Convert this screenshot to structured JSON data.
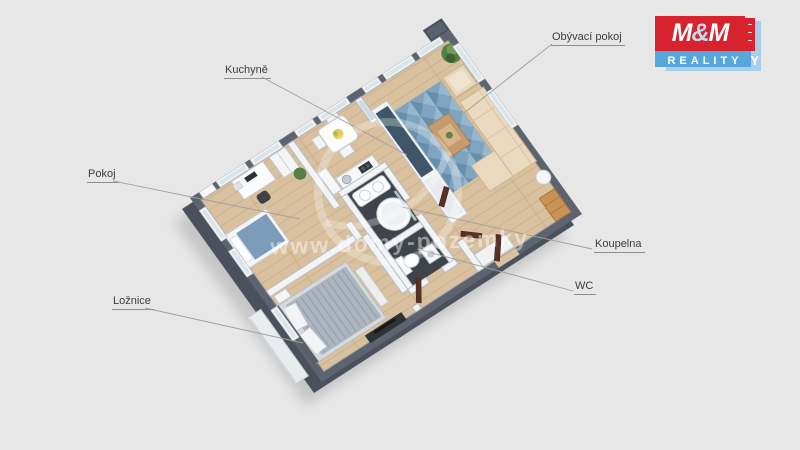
{
  "page": {
    "background_color": "#e7e7e8"
  },
  "floorplan": {
    "type": "3d-apartment-floor-plan",
    "rooms": [
      {
        "id": "obyvaci-pokoj",
        "label": "Obývací pokoj"
      },
      {
        "id": "kuchyne",
        "label": "Kuchyně"
      },
      {
        "id": "pokoj",
        "label": "Pokoj"
      },
      {
        "id": "loznice",
        "label": "Ložnice"
      },
      {
        "id": "koupelna",
        "label": "Koupelna"
      },
      {
        "id": "wc",
        "label": "WC"
      }
    ]
  },
  "watermark": {
    "text": "www.domy-pozemky"
  },
  "logo": {
    "m_left": "M",
    "ampersand": "&",
    "m_right": "M",
    "subtitle": "REALITY",
    "shadow_letter": "Y",
    "brand_red": "#d6232e",
    "brand_blue": "#58a7dc",
    "shadow_blue": "#abcdec"
  },
  "colors": {
    "exterior_wall": "#5d6470",
    "interior_wall": "#f1f3f5",
    "wood_floor": "#d9c09e",
    "bath_floor": "#3f444a",
    "rug_blue": "#7ba3c2",
    "sofa_beige": "#ead9bf",
    "door_brown": "#5a3026",
    "bed_gray": "#adb6bf"
  }
}
